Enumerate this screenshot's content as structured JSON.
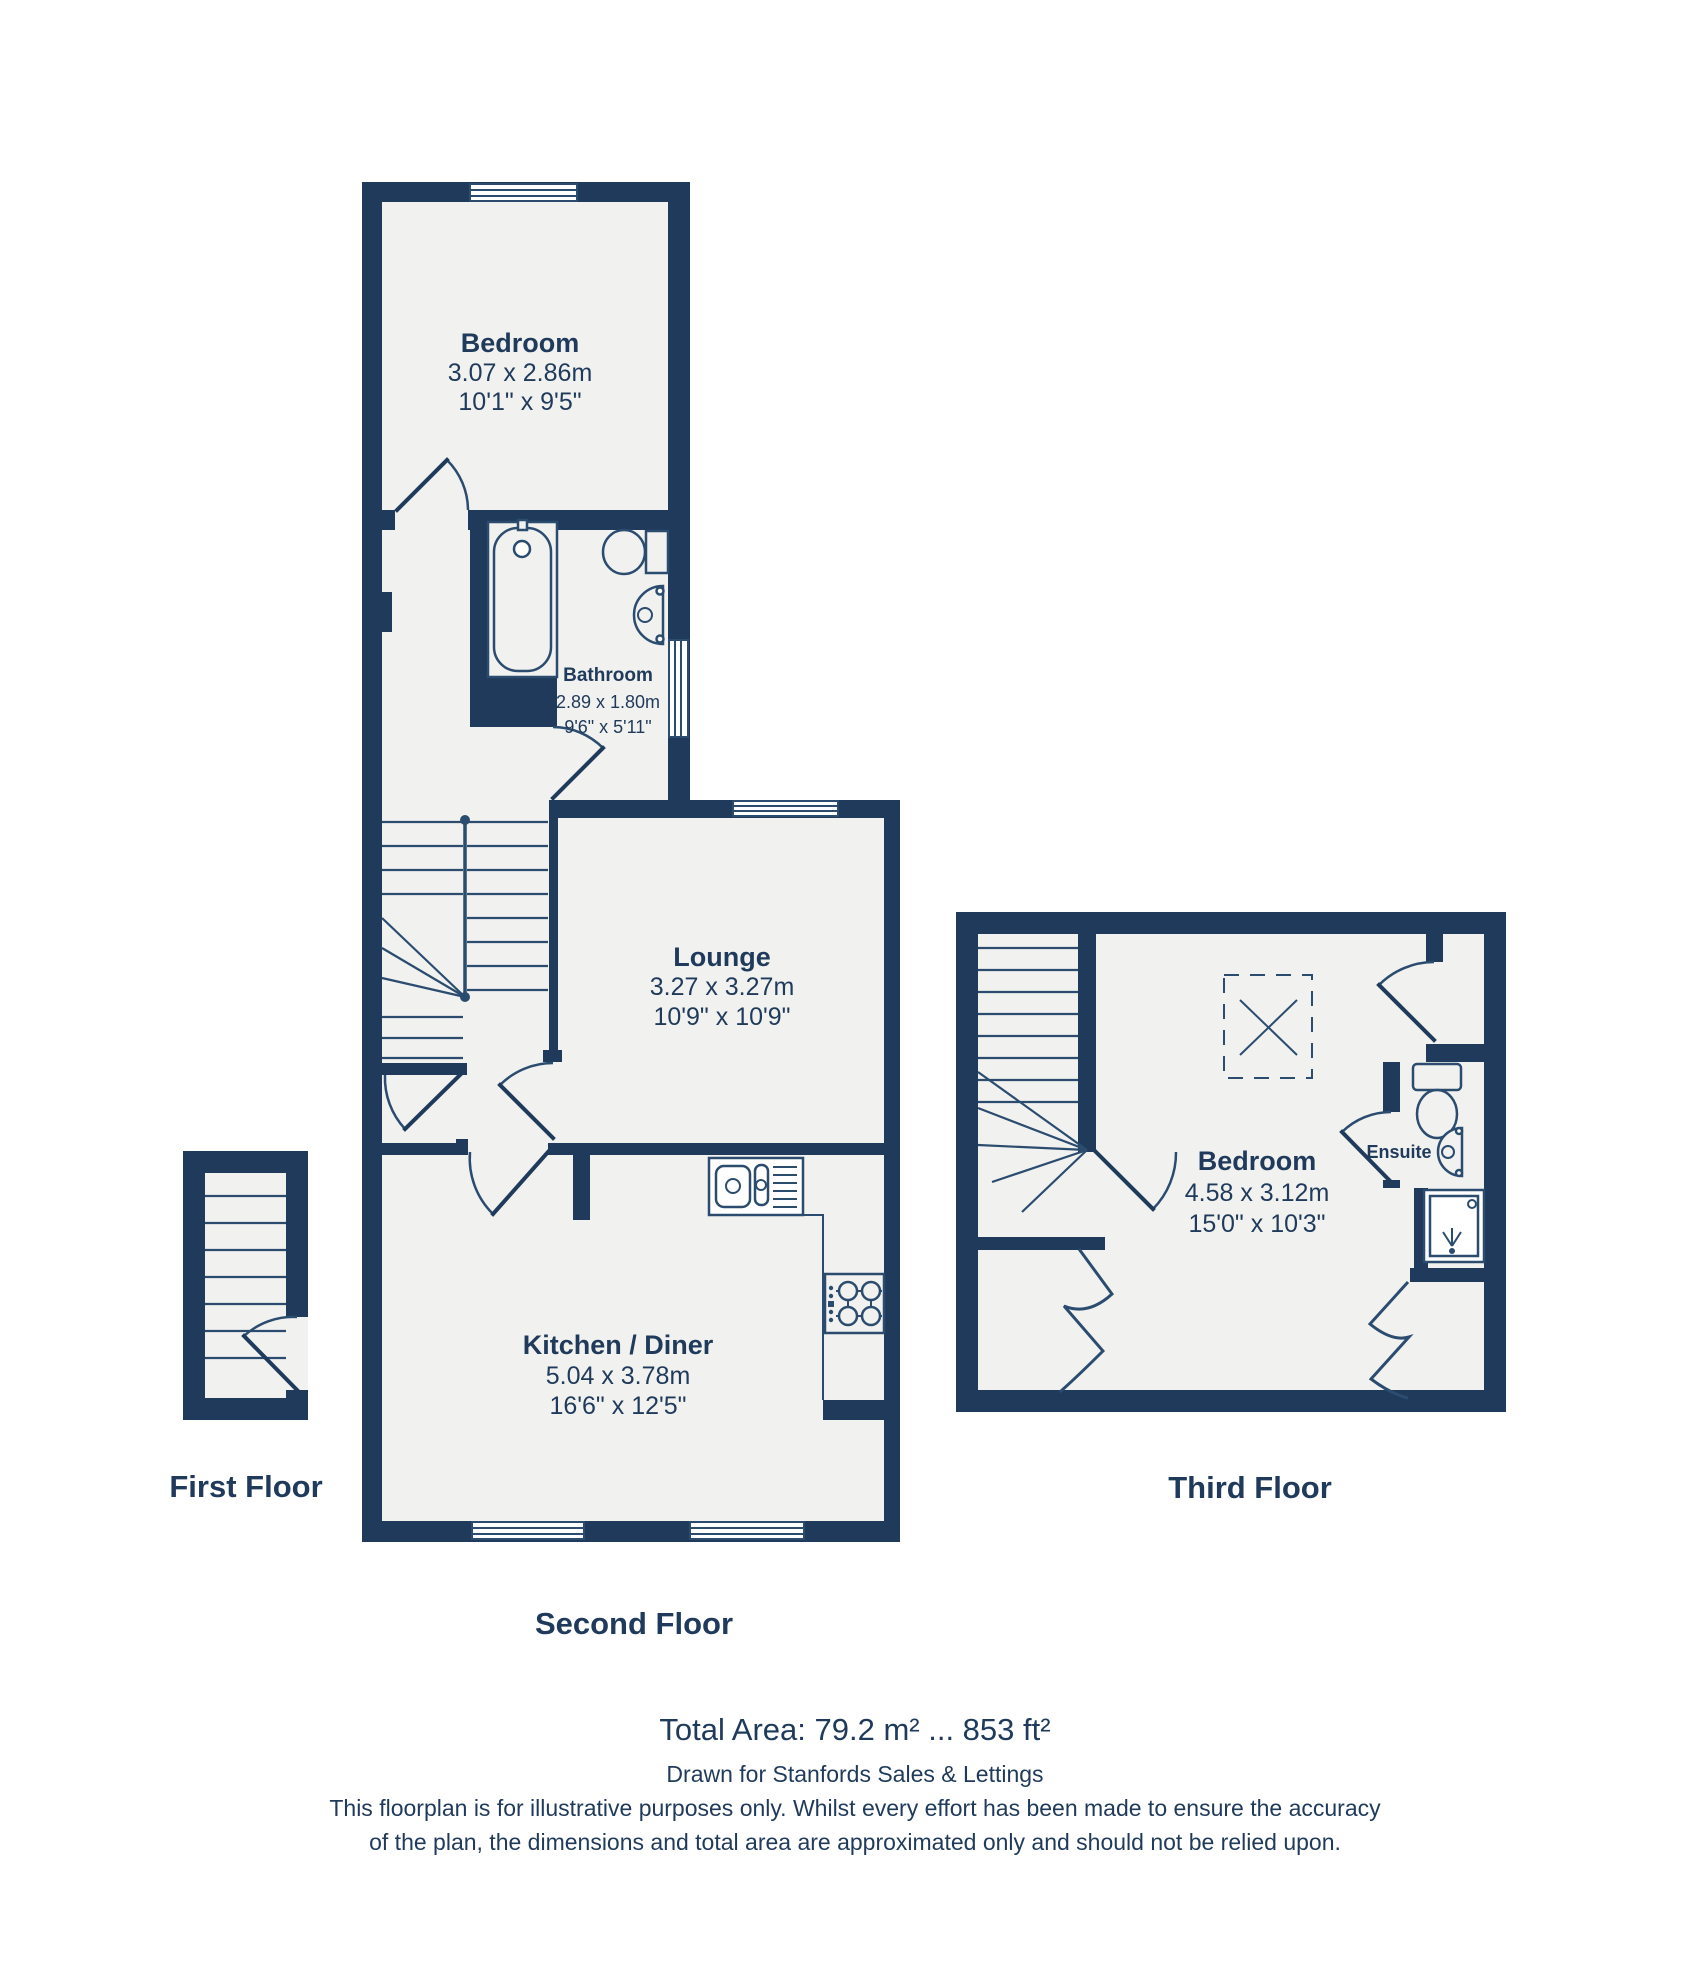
{
  "colors": {
    "wall": "#1f3a5a",
    "floor": "#f1f1ef",
    "line": "#2b4c6f",
    "text": "#1f3a5a",
    "bg": "#ffffff"
  },
  "rooms": {
    "bedroom2": {
      "name": "Bedroom",
      "metric": "3.07 x 2.86m",
      "imperial": "10'1\" x 9'5\""
    },
    "bathroom": {
      "name": "Bathroom",
      "metric": "2.89 x 1.80m",
      "imperial": "9'6\" x 5'11\""
    },
    "lounge": {
      "name": "Lounge",
      "metric": "3.27 x 3.27m",
      "imperial": "10'9\" x 10'9\""
    },
    "kitchen": {
      "name": "Kitchen / Diner",
      "metric": "5.04 x 3.78m",
      "imperial": "16'6\" x 12'5\""
    },
    "bedroom3": {
      "name": "Bedroom",
      "metric": "4.58 x 3.12m",
      "imperial": "15'0\" x 10'3\""
    },
    "ensuite": {
      "name": "Ensuite"
    }
  },
  "floors": {
    "first": {
      "label": "First Floor"
    },
    "second": {
      "label": "Second Floor"
    },
    "third": {
      "label": "Third Floor"
    }
  },
  "footer": {
    "total_area": "Total Area: 79.2 m² ... 853 ft²",
    "drawn_for": "Drawn for Stanfords Sales & Lettings",
    "disclaimer_line1": "This floorplan is for illustrative purposes only. Whilst every effort has been made to ensure the accuracy",
    "disclaimer_line2": "of the plan, the dimensions and total area are approximated only and should not be relied upon."
  }
}
